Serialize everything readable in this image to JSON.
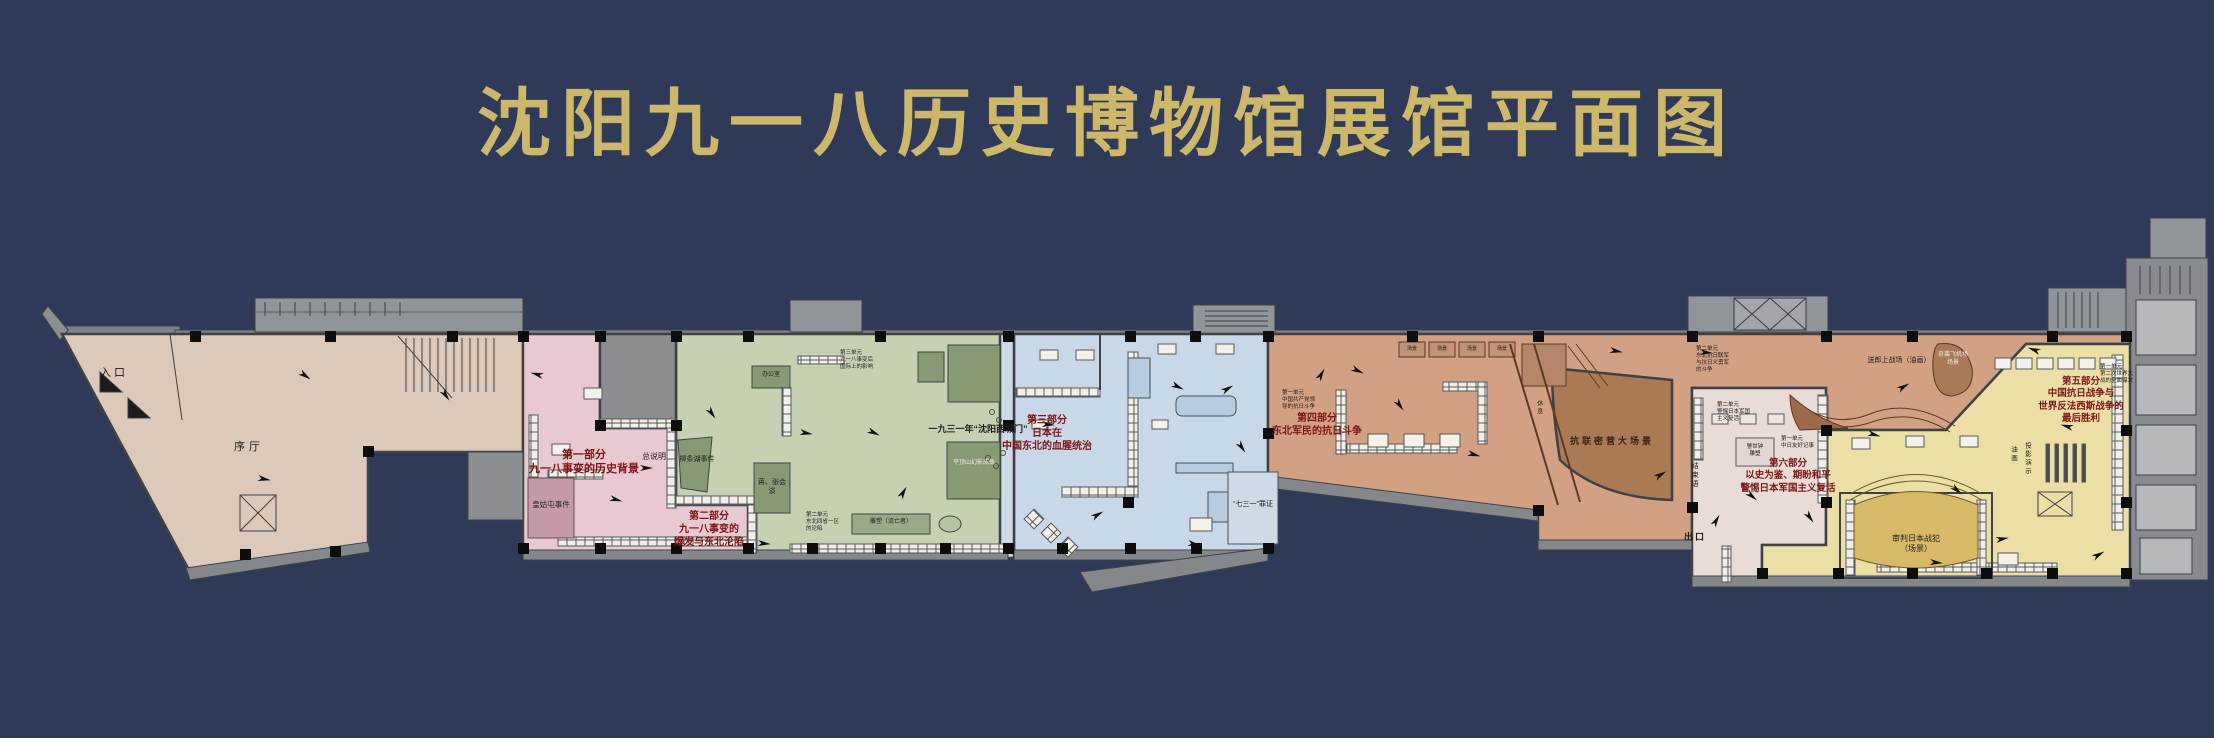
{
  "title": "沈阳九一八历史博物馆展馆平面图",
  "colors": {
    "background": "#2e3a57",
    "title_gold": "#cdb76a",
    "entrance_tan": "#dcc9ba",
    "part1_pink": "#e9c9d1",
    "part2_green": "#c6d1b2",
    "part3_blue": "#c9d8e8",
    "part4_salmon": "#d2a083",
    "part4_scene_brown": "#aa7a55",
    "part5_yellow": "#ecdfa5",
    "part5_stage": "#d7b967",
    "part6_pale": "#e9dcd6",
    "wall_gray": "#85888b",
    "accent_red": "#7c1616"
  },
  "plan": {
    "labels": {
      "entrance": "入口",
      "prologue_hall": "序厅",
      "general_intro": "总说明",
      "part1_title": "第一部分\n九一八事变的历史背景",
      "huanggutun": "皇姑屯事件",
      "part2_title": "第二部分\n九一八事变的\n爆发与东北沦陷",
      "liutiaohu": "柳条湖事件",
      "office": "办公室",
      "meeting": "蒋、张会谈",
      "unit3_part2": "第三单元\n九一八事变后\n国际上的影响",
      "unit2_part2": "第二单元\n东北四省一区\n的沦陷",
      "sculpture_exile": "雕塑（流亡者）",
      "gate_1931": "一九三一年“沈阳西城门”",
      "part3_title": "第三部分\n日本在\n中国东北的血腥统治",
      "pingdingshan": "平顶山幻影成像",
      "evidence_731": "“七三一”罪证",
      "part4_title": "第四部分\n东北军民的抗日斗争",
      "unit1_part4": "第一单元\n中国共产党领\n导的抗日斗争",
      "unit2_part4": "第二单元\n东北抗日联军\n与抗日义勇军\n的斗争",
      "kanglian_scene": "抗联密营大场景",
      "rest": "休息",
      "scene": "场景",
      "painting_songlang": "送郎上战场（油画）",
      "airfield_scene": "奇袭飞机场\n场景",
      "part5_title": "第五部分\n中国抗日战争与\n世界反法西斯战争的\n最后胜利",
      "unit1_part5": "第一单元\n第二次世界大\n战的全面爆发",
      "part6_title": "第六部分\n以史为鉴、期盼和平\n警惕日本军国主义复活",
      "unit2_part6": "第二单元\n警惕日本军国\n主义复活",
      "unit1_part6": "第一单元\n中日友好记事",
      "bell_sculpture": "警世钟\n雕塑",
      "conclusion": "结束语",
      "exit": "出口",
      "trial_scene": "审判日本战犯\n（场景）",
      "projection": "投影演示",
      "oil_painting": "油画"
    }
  }
}
